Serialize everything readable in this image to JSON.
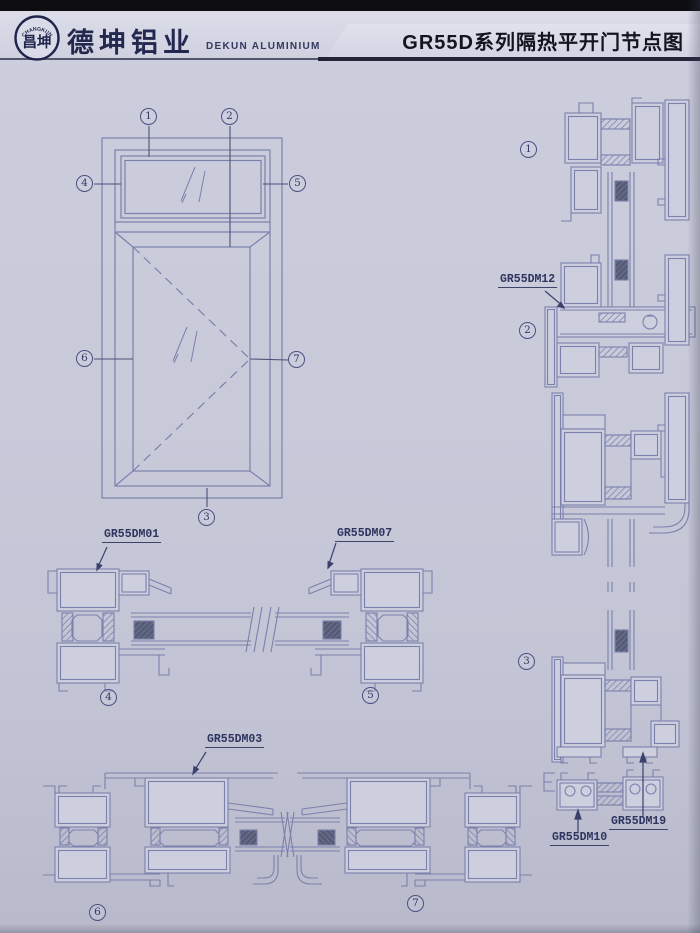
{
  "header": {
    "logo_arc": "CHANGKUN",
    "logo_chars": "昌坤",
    "company_cn": "德坤铝业",
    "company_en": "DEKUN ALUMINIUM",
    "title": "GR55D系列隔热平开门节点图"
  },
  "callouts": {
    "n1": "1",
    "n2": "2",
    "n3": "3",
    "n4": "4",
    "n5": "5",
    "n6": "6",
    "n7": "7"
  },
  "parts": {
    "dm01": "GR55DM01",
    "dm07": "GR55DM07",
    "dm03": "GR55DM03",
    "dm12": "GR55DM12",
    "dm10": "GR55DM10",
    "dm19": "GR55DM19"
  },
  "colors": {
    "paper": "#c8cada",
    "line": "#7b81ab",
    "ink": "#2e345e",
    "bar": "#0d0d12"
  }
}
